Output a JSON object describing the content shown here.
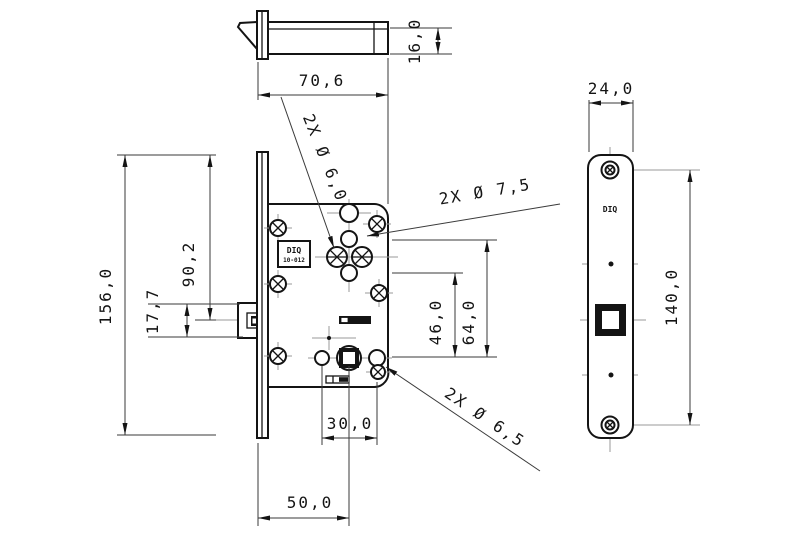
{
  "drawing": {
    "background": "#ffffff",
    "line_color": "#141414",
    "centerline_color": "#9a9a9a"
  },
  "brand": {
    "logo_line1": "DIQ",
    "logo_line2": "10-012",
    "side_logo": "DIQ"
  },
  "dimensions": {
    "case_depth": "70,6",
    "latch_body_height": "16,0",
    "overall_height": "156,0",
    "latch_center_from_top": "90,2",
    "latch_bolt_height": "17,7",
    "cylinder_to_spindle": "46,0",
    "hub_to_spindle": "64,0",
    "bottom_hole_spacing": "30,0",
    "backset": "50,0",
    "faceplate_width": "24,0",
    "faceplate_screw_spacing": "140,0"
  },
  "hole_labels": {
    "dia_6_0": "2X Ø 6,0",
    "dia_7_5": "2X Ø 7,5",
    "dia_6_5": "2X Ø 6,5"
  }
}
